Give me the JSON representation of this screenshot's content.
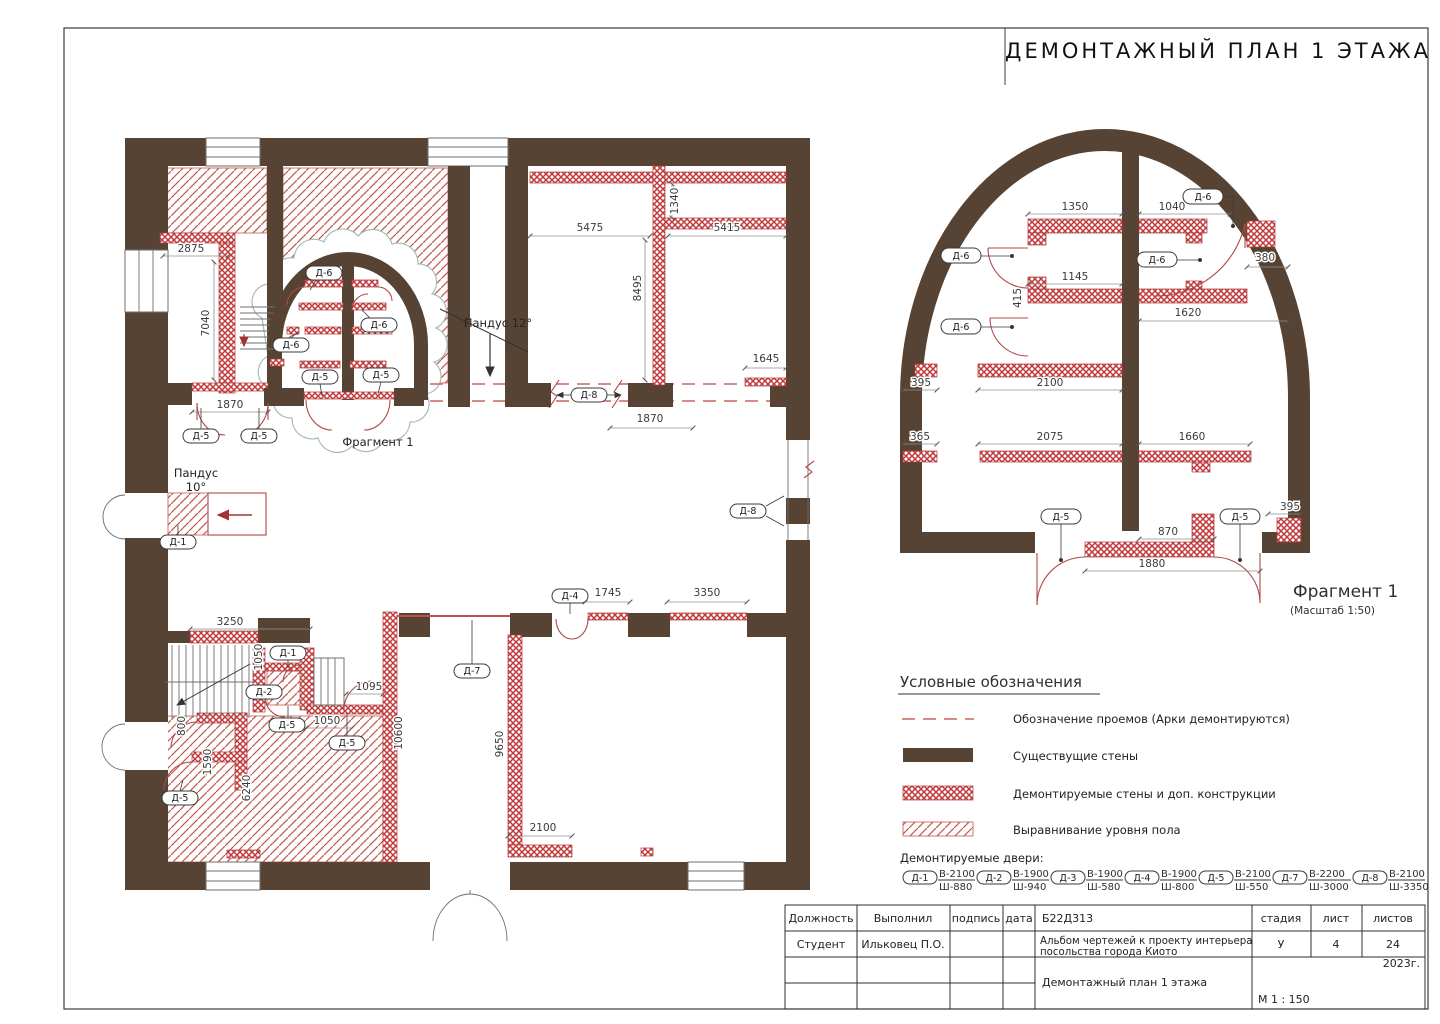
{
  "page_title": "ДЕМОНТАЖНЫЙ ПЛАН 1 ЭТАЖА",
  "colors": {
    "wall_brown": "#564334",
    "demo_red": "#bf3a3c",
    "hatch_red": "#c2574f",
    "dash_red": "#cf7b76",
    "cloud": "#a7bdb9"
  },
  "main_plan": {
    "fragment_ref": "Фрагмент 1",
    "ramp12": "Пандус 12°",
    "ramp10_line1": "Пандус",
    "ramp10_line2": "10°",
    "dims": {
      "d2875": "2875",
      "d7040": "7040",
      "d1870a": "1870",
      "d5475": "5475",
      "d5415": "5415",
      "d1340": "1340",
      "d8495": "8495",
      "d1645": "1645",
      "d1870b": "1870",
      "d3250": "3250",
      "d1050a": "1050",
      "d1095": "1095",
      "d1050b": "1050",
      "d800": "800",
      "d1590": "1590",
      "d6240": "6240",
      "d10600": "10600",
      "d9650": "9650",
      "d1745": "1745",
      "d3350": "3350",
      "d2100": "2100"
    },
    "tags": {
      "t1": "Д-5",
      "t2": "Д-5",
      "t3": "Д-6",
      "t4": "Д-6",
      "t5": "Д-6",
      "t6": "Д-5",
      "t7": "Д-5",
      "t8": "Д-8",
      "t9": "Д-8",
      "t10": "Д-1",
      "t11": "Д-1",
      "t12": "Д-2",
      "t13": "Д-5",
      "t14": "Д-5",
      "t15": "Д-5",
      "t16": "Д-7",
      "t17": "Д-4"
    }
  },
  "fragment": {
    "title": "Фрагмент 1",
    "subtitle": "(Масштаб 1:50)",
    "dims": {
      "d1350": "1350",
      "d1040": "1040",
      "d380": "380",
      "d1145": "1145",
      "d415": "415",
      "d1620": "1620",
      "d395a": "395",
      "d2100": "2100",
      "d365": "365",
      "d2075": "2075",
      "d1660": "1660",
      "d870": "870",
      "d1880": "1880",
      "d395b": "395"
    },
    "tags": {
      "f1": "Д-6",
      "f2": "Д-6",
      "f3": "Д-6",
      "f4": "Д-6",
      "f5": "Д-5",
      "f6": "Д-5"
    }
  },
  "legend": {
    "title": "Условные обозначения",
    "items": [
      {
        "label": "Обозначение проемов (Арки демонтируются)"
      },
      {
        "label": "Существущие стены"
      },
      {
        "label": "Демонтируемые стены и доп. конструкции"
      },
      {
        "label": "Выравнивание уровня пола"
      }
    ],
    "doors_title": "Демонтируемые двери:",
    "doors": [
      {
        "tag": "Д-1",
        "height": "В-2100",
        "width": "Ш-880"
      },
      {
        "tag": "Д-2",
        "height": "В-1900",
        "width": "Ш-940"
      },
      {
        "tag": "Д-3",
        "height": "В-1900",
        "width": "Ш-580"
      },
      {
        "tag": "Д-4",
        "height": "В-1900",
        "width": "Ш-800"
      },
      {
        "tag": "Д-5",
        "height": "В-2100",
        "width": "Ш-550"
      },
      {
        "tag": "Д-7",
        "height": "В-2200",
        "width": "Ш-3000"
      },
      {
        "tag": "Д-8",
        "height": "В-2100",
        "width": "Ш-3350"
      }
    ]
  },
  "title_block": {
    "headers": {
      "role": "Должность",
      "performed": "Выполнил",
      "signature": "подпись",
      "date": "дата",
      "stage": "стадия",
      "sheet": "лист",
      "sheets": "листов"
    },
    "code": "Б22Д313",
    "role_value": "Студент",
    "performed_value": "Ильковец П.О.",
    "project_line1": "Альбом чертежей к проекту интерьера",
    "project_line2": "посольства города Киото",
    "stage_value": "У",
    "sheet_value": "4",
    "sheets_value": "24",
    "drawing_title": "Демонтажный план 1 этажа",
    "year": "2023г.",
    "scale": "М 1 : 150"
  }
}
